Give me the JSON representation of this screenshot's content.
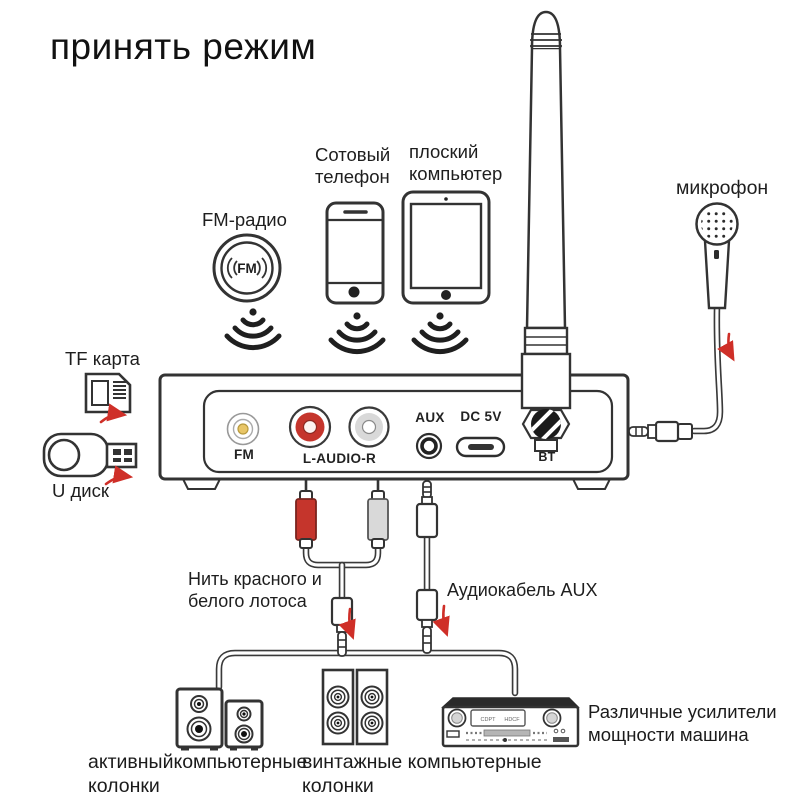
{
  "title": "принять режим",
  "labels": {
    "fm_radio": "FM-радио",
    "phone": "Сотовый\nтелефон",
    "tablet": "плоский\nкомпьютер",
    "microphone": "микрофон",
    "tf_card": "TF карта",
    "u_disk": "U диск",
    "rca_cable": "Нить красного и\nбелого лотоса",
    "aux_cable": "Аудиокабель AUX",
    "active_speakers": "активныйкомпьютерные\nколонки",
    "vintage_speakers": "винтажные компьютерные\nколонки",
    "amplifier": "Различные усилители\nмощности машина"
  },
  "device": {
    "ports": {
      "fm": "FM",
      "rca": "L-AUDIO-R",
      "aux": "AUX",
      "dc": "DC 5V",
      "bt": "BT"
    }
  },
  "icons": {
    "fm_badge": "FM"
  },
  "amplifier_display": {
    "left": "CDPT",
    "right": "HDCF"
  },
  "colors": {
    "background": "#ffffff",
    "line": "#333333",
    "accent_red": "#cf2f28",
    "rca_red": "#c5352c",
    "rca_white": "#d9d9d9",
    "fm_jack_yellow": "#e8c566"
  }
}
